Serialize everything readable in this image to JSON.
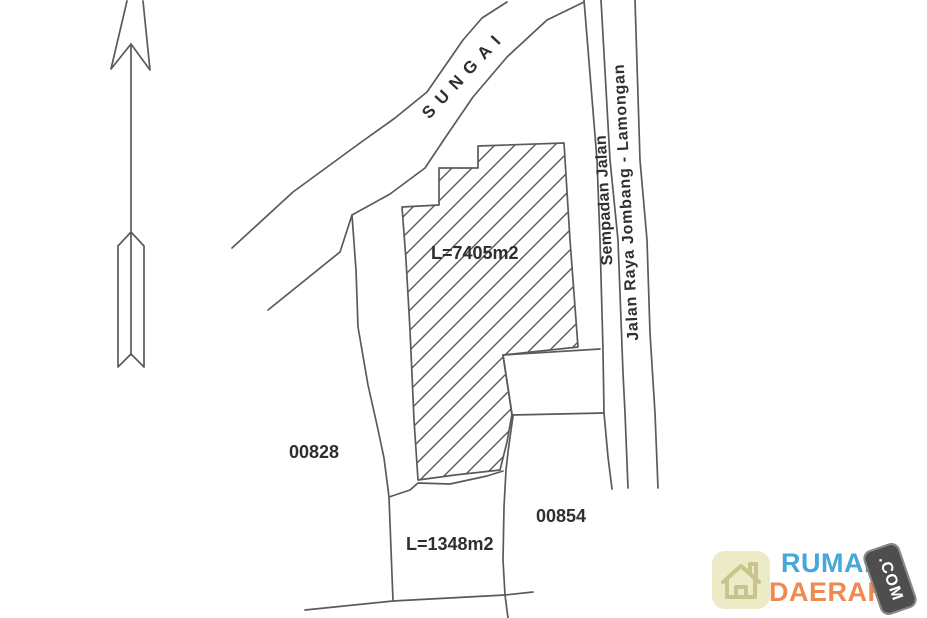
{
  "plan": {
    "river_label": "SUNGAI",
    "road_edge_label": "Sempadan Jalan",
    "road_name_label": "Jalan Raya Jombang - Lamongan",
    "main_parcel_area": "L=7405m2",
    "south_parcel_area": "L=1348m2",
    "west_parcel_number": "00828",
    "east_parcel_number": "00854",
    "colors": {
      "line": "#4d4d4d",
      "text": "#2f2f2f",
      "hatch": "#4a4a4a"
    }
  },
  "logo": {
    "brand_top": "RUMAH",
    "brand_bottom": "DAERAH",
    "badge_text": ".COM",
    "colors": {
      "brand_top": "#46a7d8",
      "brand_bottom": "#ef8a50",
      "badge_bg": "#4e4e4e",
      "badge_border": "#8a8a8a",
      "badge_text": "#ffffff",
      "icon_bg": "#ecebc7",
      "icon_outline": "#c9c38c"
    }
  }
}
